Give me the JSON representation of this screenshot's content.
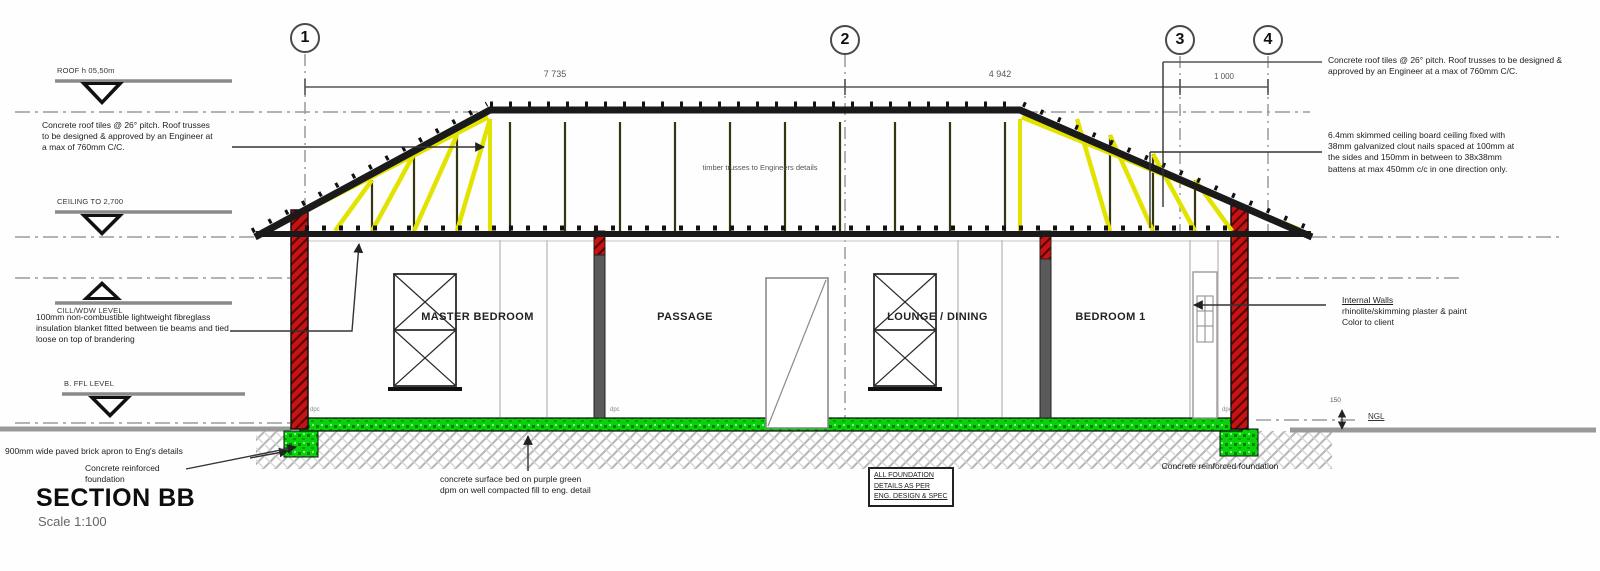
{
  "title": {
    "label": "SECTION BB",
    "scale": "Scale 1:100"
  },
  "grid": {
    "bubbles": [
      "1",
      "2",
      "3",
      "4"
    ]
  },
  "dimensions": {
    "span_1_2": "7 735",
    "span_2_3": "4 942",
    "span_3_4": "1 000",
    "ngl_label": "NGL",
    "ngl_offset": "150"
  },
  "levels": [
    {
      "label": "ROOF h 05,50m"
    },
    {
      "label": "CEILING TO 2,700"
    },
    {
      "label": "CILL/WDW LEVEL"
    },
    {
      "label": "B. FFL LEVEL"
    }
  ],
  "rooms": [
    {
      "label": "MASTER BEDROOM"
    },
    {
      "label": "PASSAGE"
    },
    {
      "label": "LOUNGE / DINING"
    },
    {
      "label": "BEDROOM 1"
    }
  ],
  "notes": {
    "roof_left": "Concrete roof tiles @ 26° pitch. Roof trusses to be designed & approved by an Engineer at a max of 760mm C/C.",
    "roof_right": "Concrete roof tiles @ 26° pitch. Roof trusses to be designed & approved by an Engineer at a max of 760mm C/C.",
    "ceiling": "6.4mm skimmed ceiling board ceiling fixed with 38mm galvanized clout nails spaced at 100mm at the sides and 150mm in between to 38x38mm battens at max 450mm c/c in one direction only.",
    "internal_walls_title": "Internal Walls",
    "internal_walls_line1": "rhinolite/skimming plaster & paint",
    "internal_walls_line2": "Color to client",
    "insulation": "100mm non-combustible lightweight fibreglass insulation blanket fitted between tie beams and tied loose on top of brandering",
    "truss": "timber trusses to Engineers details",
    "apron": "900mm wide paved brick apron to Eng's details",
    "foundation_left": "Concrete reinforced foundation",
    "foundation_right": "Concrete reinforced foundation",
    "surface_bed": "concrete surface bed on purple green dpm on well compacted fill to eng. detail",
    "foundation_box": [
      "ALL FOUNDATION",
      "DETAILS AS PER",
      "ENG. DESIGN & SPEC"
    ],
    "dpc": "dpc"
  },
  "colors": {
    "truss_yellow": "#e3e300",
    "wall_red_hatch": "#c41414",
    "floor_green": "#0ad20a",
    "ground_hatch_gray": "#b5b5b5",
    "line_dark": "#1a1a1a"
  }
}
